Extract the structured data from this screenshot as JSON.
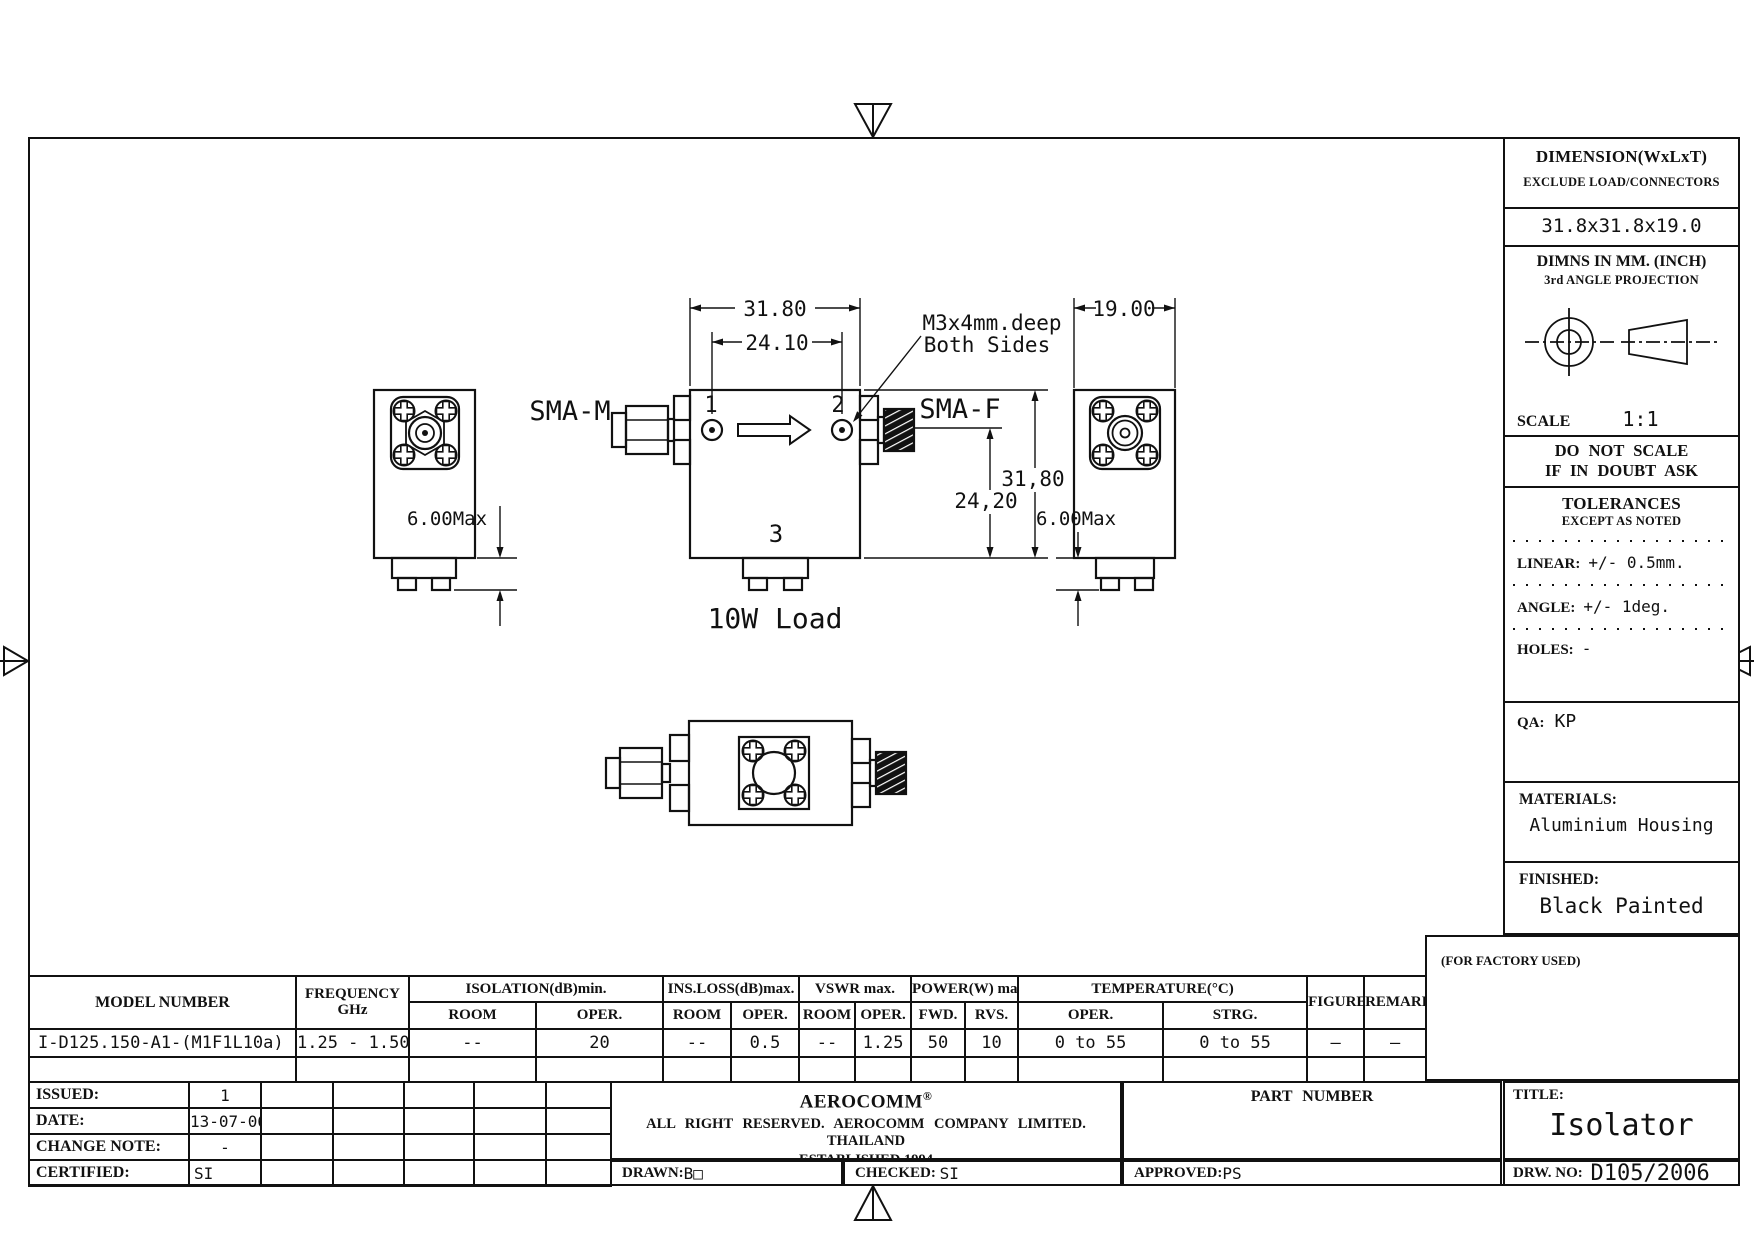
{
  "sidebar": {
    "dimension_title": "DIMENSION(WxLxT)",
    "dimension_subtitle": "EXCLUDE LOAD/CONNECTORS",
    "dimension_value": "31.8x31.8x19.0",
    "units_line1": "DIMNS IN MM. (INCH)",
    "units_line2": "3rd ANGLE PROJECTION",
    "scale_label": "SCALE",
    "scale_value": "1:1",
    "warning_line1": "DO NOT SCALE",
    "warning_line2": "IF IN DOUBT ASK",
    "tolerances_title": "TOLERANCES",
    "tolerances_subtitle": "EXCEPT AS NOTED",
    "linear_label": "LINEAR:",
    "linear_value": "+/-  0.5mm.",
    "angle_label": "ANGLE:",
    "angle_value": "+/- 1deg.",
    "holes_label": "HOLES:",
    "holes_value": "-",
    "qa_label": "QA:",
    "qa_value": "KP",
    "materials_label": "MATERIALS:",
    "materials_value": "Aluminium Housing",
    "finished_label": "FINISHED:",
    "finished_value": "Black Painted",
    "factory_note": "(FOR FACTORY USED)"
  },
  "drawing": {
    "dim_width_top": "31.80",
    "dim_ports": "24.10",
    "dim_depth": "19.00",
    "dim_height_right": "31,80",
    "dim_port_height": "24,20",
    "dim_load_left": "6.00Max",
    "dim_load_right": "6.00Max",
    "sma_m": "SMA-M",
    "sma_f": "SMA-F",
    "port1": "1",
    "port2": "2",
    "port3": "3",
    "callout_line1": "M3x4mm.deep",
    "callout_line2": "Both Sides",
    "load_label": "10W Load"
  },
  "spec_table": {
    "col_model": "MODEL NUMBER",
    "col_freq_1": "FREQUENCY",
    "col_freq_2": "GHz",
    "groups": [
      {
        "label": "ISOLATION(dB)min.",
        "sub1": "ROOM",
        "sub2": "OPER."
      },
      {
        "label": "INS.LOSS(dB)max.",
        "sub1": "ROOM",
        "sub2": "OPER."
      },
      {
        "label": "VSWR max.",
        "sub1": "ROOM",
        "sub2": "OPER."
      },
      {
        "label": "POWER(W) max.",
        "sub1": "FWD.",
        "sub2": "RVS."
      },
      {
        "label": "TEMPERATURE(°C)",
        "sub1": "OPER.",
        "sub2": "STRG."
      }
    ],
    "col_figure": "FIGURE",
    "col_remark": "REMARK",
    "row": {
      "model": "I-D125.150-A1-(M1F1L10a)",
      "freq": "1.25 - 1.50",
      "iso_room": "--",
      "iso_oper": "20",
      "loss_room": "--",
      "loss_oper": "0.5",
      "vswr_room": "--",
      "vswr_oper": "1.25",
      "pwr_fwd": "50",
      "pwr_rvs": "10",
      "temp_oper": "0 to 55",
      "temp_strg": "0 to 55",
      "figure": "—",
      "remark": "—"
    }
  },
  "title_block": {
    "issued_label": "ISSUED:",
    "issued_value": "1",
    "date_label": "DATE:",
    "date_value": "13-07-06",
    "change_note_label": "CHANGE NOTE:",
    "change_note_value": "-",
    "certified_label": "CERTIFIED:",
    "certified_value": "SI",
    "company_name": "AEROCOMM",
    "company_reg": "®",
    "company_line1": "ALL RIGHT RESERVED.  AEROCOMM COMPANY LIMITED.  THAILAND",
    "company_line2": "ESTABLISHED 1994",
    "drawn_label": "DRAWN:",
    "drawn_value": "B□",
    "checked_label": "CHECKED: ",
    "checked_value": "SI",
    "part_number_label": "PART NUMBER",
    "approved_label": "APPROVED:",
    "approved_value": "PS",
    "title_label": "TITLE:",
    "title_value": "Isolator",
    "drw_no_label": "DRW. NO: ",
    "drw_no_value": "D105/2006"
  }
}
